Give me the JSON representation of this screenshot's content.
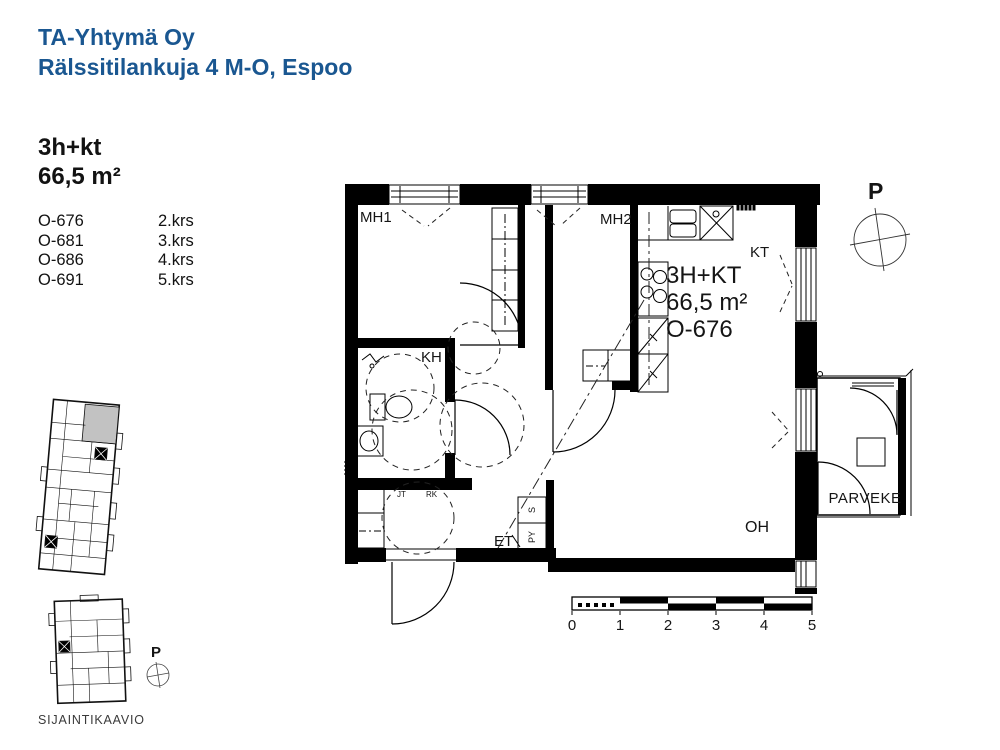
{
  "header": {
    "company": "TA-Yhtymä Oy",
    "address": "Rälssitilankuja 4 M-O, Espoo"
  },
  "apartment": {
    "type": "3h+kt",
    "area": "66,5 m²",
    "units": [
      {
        "id": "O-676",
        "floor": "2.krs"
      },
      {
        "id": "O-681",
        "floor": "3.krs"
      },
      {
        "id": "O-686",
        "floor": "4.krs"
      },
      {
        "id": "O-691",
        "floor": "5.krs"
      }
    ]
  },
  "plan": {
    "unit_label": {
      "type": "3H+KT",
      "area": "66,5 m²",
      "id": "O-676"
    },
    "rooms": {
      "mh1": "MH1",
      "mh2": "MH2",
      "kt": "KT",
      "kh": "KH",
      "oh": "OH",
      "et": "ET",
      "parveke": "PARVEKE",
      "s": "S",
      "py": "PY",
      "jt": "JT",
      "rk": "RK"
    },
    "north_label": "P",
    "scale_ticks": [
      "0",
      "1",
      "2",
      "3",
      "4",
      "5"
    ]
  },
  "location": {
    "caption": "SIJAINTIKAAVIO",
    "north_label": "P"
  },
  "colors": {
    "brand_blue": "#1a5791",
    "highlight_gray": "#c2c2c2",
    "plan_black": "#000000"
  }
}
